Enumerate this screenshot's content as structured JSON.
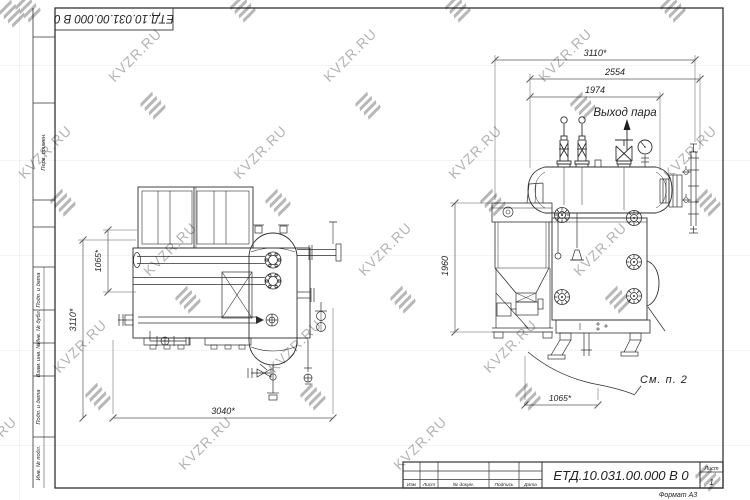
{
  "watermark": {
    "label": "KVZR.RU"
  },
  "sheet": {
    "side_column_labels": [
      "Перв. примен.",
      "Подп. и дата",
      "Инв. № дубл.",
      "Взам. инв. №",
      "Подп. и дата",
      "Инв. № подл."
    ],
    "top_stamp_doc_number": "ЕТД.10.031.00.000 В 0"
  },
  "title_block": {
    "doc_number": "ЕТД.10.031.00.000 В 0",
    "revision_columns": [
      "Изм",
      "Лист",
      "№ докум.",
      "Подпись",
      "Дата"
    ],
    "sheet_label": "Лист",
    "sheet_number": "1",
    "format_note": "Формат А3"
  },
  "plan_view": {
    "dim_height": "3110*",
    "dim_drum_offset": "1065*",
    "dim_width": "3040*"
  },
  "side_view": {
    "dim_overall": "3110*",
    "dim_shell": "2554",
    "dim_drum": "1974",
    "dim_height": "1960",
    "dim_base": "1065*",
    "label_steam_outlet": "Выход пара",
    "label_see_item": "См. п. 2"
  }
}
